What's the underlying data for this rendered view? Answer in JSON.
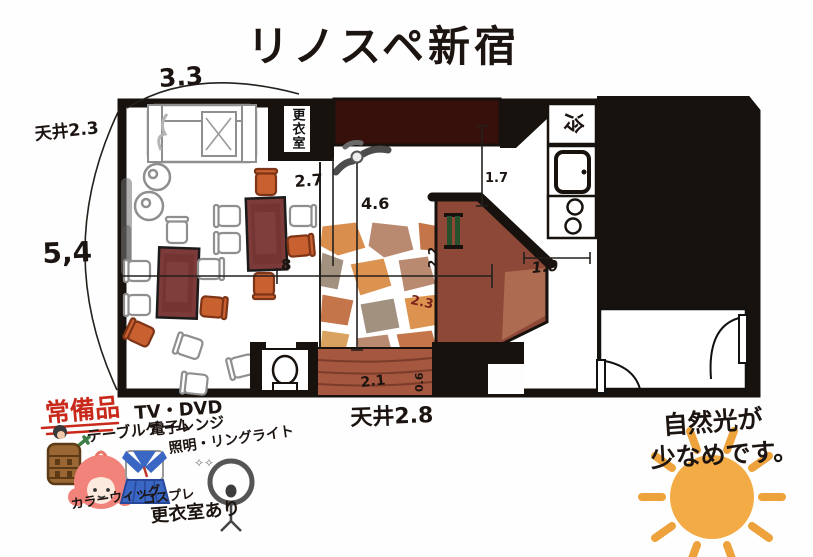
{
  "title": "リノスペ新宿",
  "plan": {
    "labels": {
      "changing_room": "更衣室",
      "fridge": "冷"
    },
    "dims": {
      "top_width": "3.3",
      "ceiling_left": "天井2.3",
      "left_height": "5,4",
      "entry_depth": "2.7",
      "floor_length": "4.6",
      "kitchen_side": "1.7",
      "corridor": "1.0",
      "mid_width": "8",
      "counter_width": "2.2",
      "stone_diag": "2.3",
      "step_depth": "0.6",
      "step_width": "2.1",
      "ceiling_main": "天井2.8"
    }
  },
  "amenities": {
    "heading": "常備品",
    "items": [
      "TV・DVD",
      "テーブルゲーム",
      "電子レンジ",
      "照明・リングライト",
      "カラーウィッグ",
      "コスプレ",
      "更衣室あり"
    ],
    "sparkle": "✧✧"
  },
  "note": {
    "line1": "自然光が",
    "line2": "少なめです。"
  },
  "colors": {
    "wall": "#17120e",
    "table": "#7c3a38",
    "accent_chair": "#c9602f",
    "counter": "#8e4837",
    "step": "#a5573f",
    "band": "#38100b",
    "heading_red": "#c9291b",
    "sun": "#f3ab45",
    "uniform_blue": "#3a66c4",
    "hair_pink": "#f2837b"
  }
}
